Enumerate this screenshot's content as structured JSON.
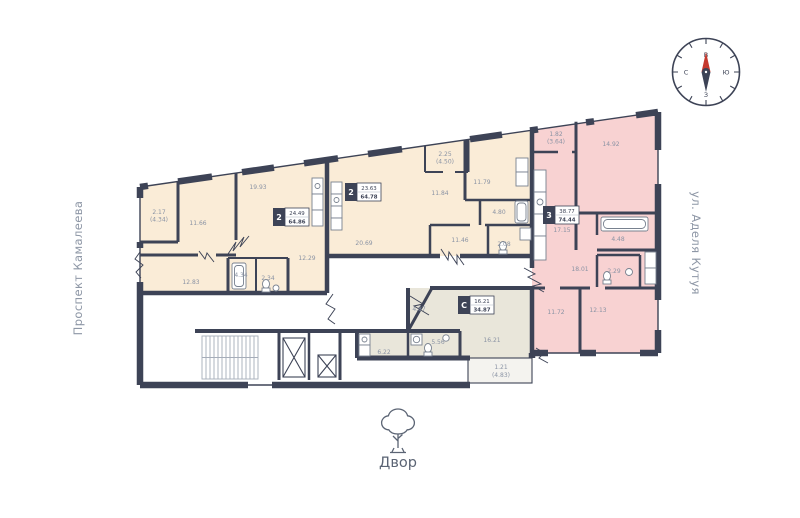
{
  "compass": {
    "top": "В",
    "right": "Ю",
    "bottom": "З",
    "left": "С"
  },
  "streets": {
    "left": "Проспект Камалеева",
    "right": "ул. Аделя Кутуя"
  },
  "courtyard": {
    "label": "Двор"
  },
  "colors": {
    "wall": "#3d4356",
    "apartment_beige": "#faecd7",
    "apartment_pink": "#f8d2d2",
    "studio_gray": "#e9e6da",
    "balcony_gray": "#f4f3ef",
    "label_gray": "#8a93a4",
    "needle_red": "#c5392e"
  },
  "apartments": {
    "left": {
      "number": "2",
      "living_area": "24.49",
      "total_area": "64.86",
      "rooms": {
        "balcony": "2.17",
        "balcony_full": "(4.34)",
        "bedroom": "11.66",
        "kitchen_living": "19.93",
        "hall": "12.29",
        "bath": "4.34",
        "wc": "2.34",
        "bedroom2": "12.83"
      }
    },
    "middle": {
      "number": "2",
      "living_area": "23.63",
      "total_area": "64.78",
      "rooms": {
        "balcony": "2.25",
        "balcony_full": "(4.50)",
        "bedroom": "11.84",
        "bedroom2": "11.79",
        "bath": "4.80",
        "kitchen_living": "20.69",
        "hall": "11.46",
        "wc": "2.08"
      }
    },
    "right": {
      "number": "3",
      "living_area": "38.77",
      "total_area": "74.44",
      "rooms": {
        "balcony": "1.82",
        "balcony_full": "(3.64)",
        "bedroom": "14.92",
        "kitchen": "17.15",
        "bath": "4.48",
        "hall": "18.01",
        "wc": "2.29",
        "bedroom2": "11.72",
        "bedroom3": "12.13"
      }
    },
    "studio": {
      "number": "С",
      "living_area": "16.21",
      "total_area": "34.87",
      "rooms": {
        "hall": "4.87",
        "bath": "5.56",
        "kitchen": "6.22",
        "living": "16.21",
        "balcony": "1.21",
        "balcony_full": "(4.83)"
      }
    }
  }
}
